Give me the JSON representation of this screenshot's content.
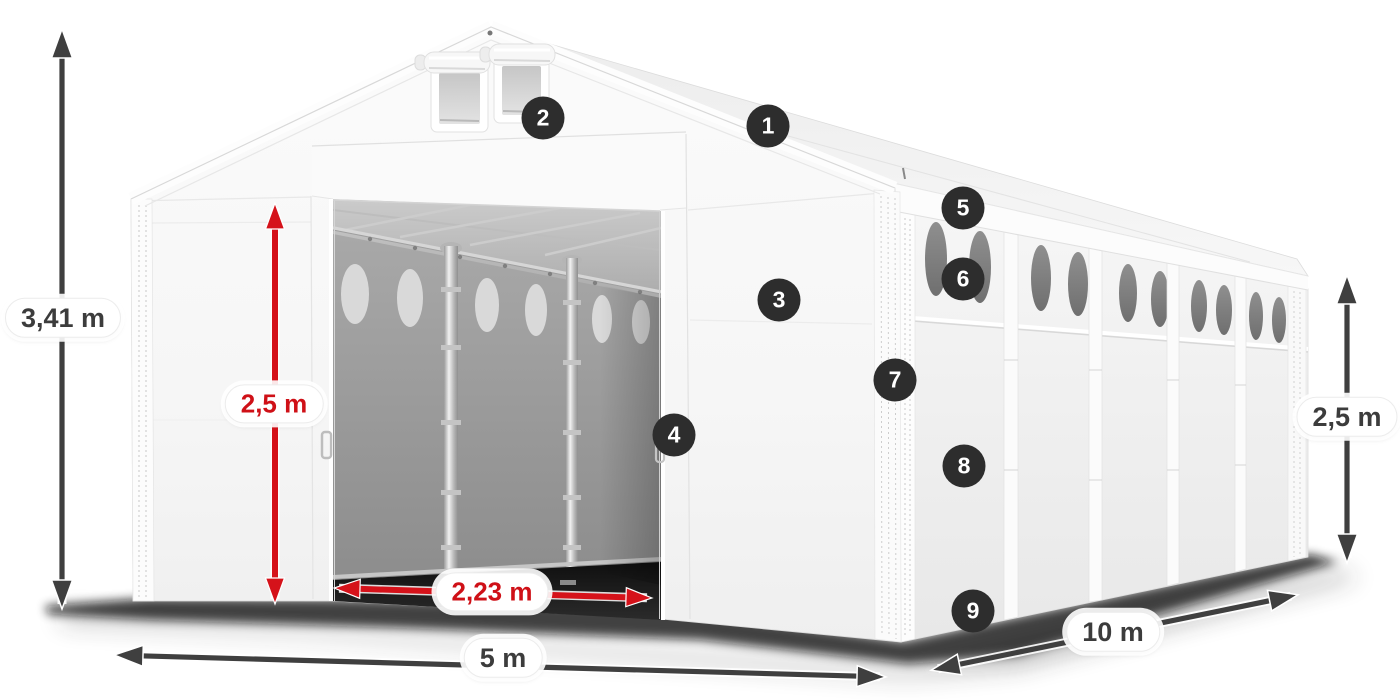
{
  "dimensions": {
    "total_height": "3,41 m",
    "door_height": "2,5 m",
    "door_width": "2,23 m",
    "front_width": "5 m",
    "side_length": "10 m",
    "side_wall_height": "2,5 m"
  },
  "markers": [
    "1",
    "2",
    "3",
    "4",
    "5",
    "6",
    "7",
    "8",
    "9"
  ],
  "colors": {
    "dimension_red": "#d5121a",
    "dimension_dark": "#3f3f3f",
    "marker_background": "#2d2d2d",
    "marker_text": "#ffffff"
  }
}
